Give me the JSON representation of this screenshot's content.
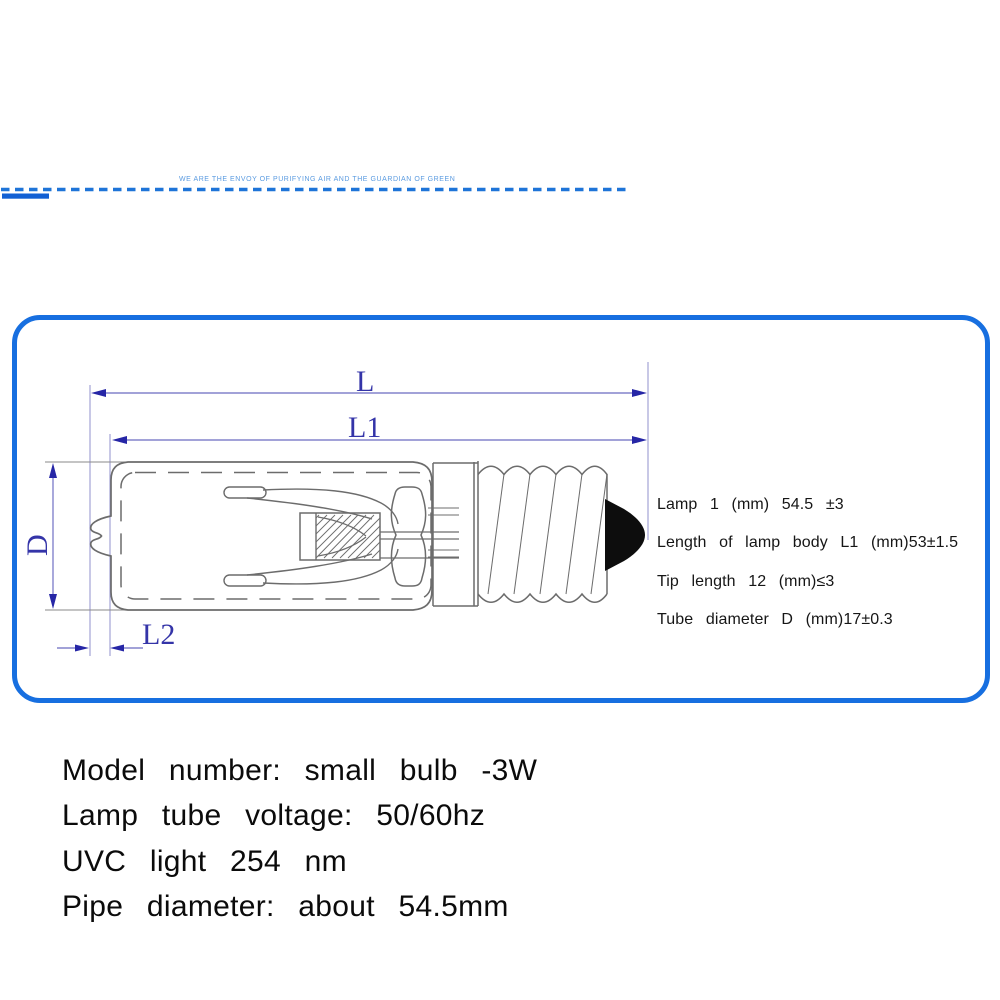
{
  "banner": {
    "slogan": "WE ARE THE ENVOY OF PURIFYING AIR AND THE GUARDIAN OF GREEN"
  },
  "diagram": {
    "labels": {
      "overall_length": "L",
      "body_length": "L1",
      "tube_diameter": "D",
      "tip_length": "L2"
    },
    "specs": [
      "Lamp 1 (mm) 54.5 ±3",
      "Length of lamp body L1 (mm)53±1.5",
      "Tip length 12 (mm)≤3",
      "Tube diameter D (mm)17±0.3"
    ]
  },
  "details": [
    "Model number: small bulb -3W",
    "Lamp tube voltage: 50/60hz",
    "UVC light 254 nm",
    "Pipe diameter: about 54.5mm"
  ],
  "colors": {
    "panel_border": "#176fe0",
    "banner_blue": "#1e74d8",
    "banner_bar": "#1160d4",
    "dimension_line": "#8484cc",
    "dimension_label": "#3434a8",
    "drawing_line": "#6c6c6c",
    "solder_tip": "#0d0d0d"
  }
}
